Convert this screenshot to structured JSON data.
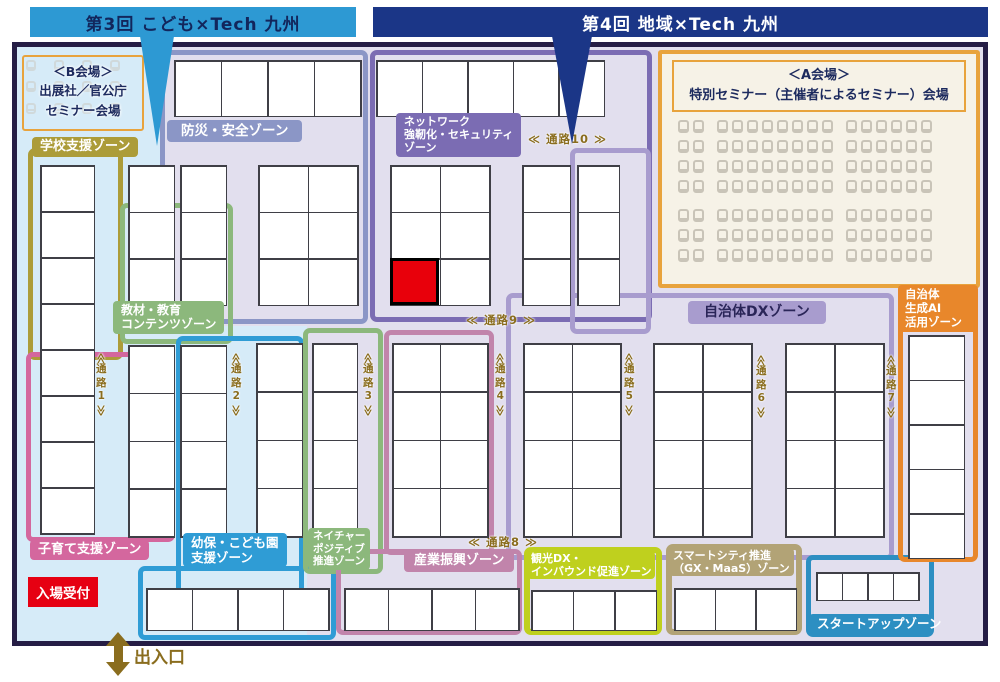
{
  "banners": {
    "left": {
      "label": "第3回 こども×Tech 九州",
      "color": "#2d99d3"
    },
    "right": {
      "label": "第4回 地域×Tech 九州",
      "color": "#1b3687"
    }
  },
  "halls": {
    "b": {
      "lines": [
        "＜B会場＞",
        "出展社／官公庁",
        "セミナー会場"
      ],
      "border_color": "#e8a33d",
      "seats": {
        "rows": 3,
        "cols": 4
      }
    },
    "a": {
      "lines": [
        "＜A会場＞",
        "特別セミナー（主催者によるセミナー）会場"
      ],
      "border_color": "#e8a33d",
      "seats": {
        "rows": 7,
        "groups": [
          2,
          8,
          6
        ]
      }
    }
  },
  "zones": {
    "school": {
      "label": "学校支援ゾーン",
      "color": "#ac9c39"
    },
    "bosai": {
      "label": "防災・安全ゾーン",
      "color": "#8b96c6"
    },
    "network": {
      "lines": [
        "ネットワーク",
        "強靭化・セキュリティ",
        "ゾーン"
      ],
      "color": "#7b6cb3"
    },
    "kyozai": {
      "lines": [
        "教材・教育",
        "コンテンツゾーン"
      ],
      "color": "#8cb87c"
    },
    "childcare": {
      "label": "子育て支援ゾーン",
      "color": "#d4679e"
    },
    "yoho": {
      "lines": [
        "幼保・こども園",
        "支援ゾーン"
      ],
      "color": "#2f9cd5"
    },
    "nature": {
      "lines": [
        "ネイチャー",
        "ポジティブ",
        "推進ゾーン"
      ],
      "color": "#8cb87c"
    },
    "sangyo": {
      "label": "産業振興ゾーン",
      "color": "#c184ab"
    },
    "kanko": {
      "lines": [
        "観光DX・",
        "インバウンド促進ゾーン"
      ],
      "color": "#bfd01e"
    },
    "smart": {
      "lines": [
        "スマートシティ推進",
        "（GX・MaaS）ゾーン"
      ],
      "color": "#b2a376"
    },
    "startup": {
      "label": "スタートアップゾーン",
      "color": "#2d8fc2"
    },
    "dx": {
      "label": "自治体DXゾーン",
      "color": "#a89cce"
    },
    "ai": {
      "lines": [
        "自治体",
        "生成AI",
        "活用ゾーン"
      ],
      "color": "#e8872b"
    }
  },
  "aisles": {
    "prefix": "≪",
    "suffix": "≫",
    "vertical": [
      "通路1",
      "通路2",
      "通路3",
      "通路4",
      "通路5",
      "通路6",
      "通路7"
    ],
    "horizontal": [
      "通路8",
      "通路9",
      "通路10"
    ]
  },
  "reception": {
    "label": "入場受付",
    "color": "#e60012"
  },
  "entrance": {
    "label": "出入口",
    "color": "#8a6d1e"
  },
  "highlight_booth": {
    "color": "#e8000b",
    "zone": "ネットワーク強靭化・セキュリティゾーン"
  },
  "map": {
    "grids": [
      {
        "id": "bosai-top-row",
        "x": 174,
        "y": 60,
        "cols": 4,
        "rows": 1,
        "cw": 45,
        "ch": 54
      },
      {
        "id": "network-top-row",
        "x": 376,
        "y": 60,
        "cols": 5,
        "rows": 1,
        "cw": 44,
        "ch": 54
      },
      {
        "id": "school-col",
        "x": 40,
        "y": 165,
        "cols": 1,
        "rows": 8,
        "cw": 52,
        "ch": 44.5
      },
      {
        "id": "col2-upper",
        "x": 128,
        "y": 165,
        "cols": 1,
        "rows": 3,
        "cw": 44,
        "ch": 45
      },
      {
        "id": "col2-lower",
        "x": 128,
        "y": 345,
        "cols": 1,
        "rows": 4,
        "cw": 44,
        "ch": 46.25
      },
      {
        "id": "col3-upper",
        "x": 180,
        "y": 165,
        "cols": 1,
        "rows": 3,
        "cw": 44,
        "ch": 45
      },
      {
        "id": "col3-lower",
        "x": 180,
        "y": 345,
        "cols": 1,
        "rows": 4,
        "cw": 44,
        "ch": 46.25
      },
      {
        "id": "bosai-grid",
        "x": 258,
        "y": 165,
        "cols": 2,
        "rows": 3,
        "cw": 48,
        "ch": 45
      },
      {
        "id": "network-grid",
        "x": 390,
        "y": 165,
        "cols": 2,
        "rows": 3,
        "cw": 48,
        "ch": 45
      },
      {
        "id": "network-col-right",
        "x": 522,
        "y": 165,
        "cols": 1,
        "rows": 3,
        "cw": 46,
        "ch": 45
      },
      {
        "id": "dx-arm-col",
        "x": 577,
        "y": 165,
        "cols": 1,
        "rows": 3,
        "cw": 40,
        "ch": 45
      },
      {
        "id": "col4-lower",
        "x": 256,
        "y": 343,
        "cols": 1,
        "rows": 4,
        "cw": 44,
        "ch": 46.75
      },
      {
        "id": "nature-col",
        "x": 312,
        "y": 343,
        "cols": 1,
        "rows": 4,
        "cw": 43,
        "ch": 46.75
      },
      {
        "id": "sangyo-upper-grid",
        "x": 392,
        "y": 343,
        "cols": 2,
        "rows": 4,
        "cw": 46,
        "ch": 46.75
      },
      {
        "id": "dx-grid-1",
        "x": 523,
        "y": 343,
        "cols": 2,
        "rows": 4,
        "cw": 47,
        "ch": 46.75
      },
      {
        "id": "dx-grid-2",
        "x": 653,
        "y": 343,
        "cols": 2,
        "rows": 4,
        "cw": 47.5,
        "ch": 46.75
      },
      {
        "id": "dx-grid-3",
        "x": 785,
        "y": 343,
        "cols": 2,
        "rows": 4,
        "cw": 47.5,
        "ch": 46.75
      },
      {
        "id": "ai-col",
        "x": 908,
        "y": 335,
        "cols": 1,
        "rows": 5,
        "cw": 54,
        "ch": 43
      },
      {
        "id": "yoho-bottom-row",
        "x": 146,
        "y": 588,
        "cols": 4,
        "rows": 1,
        "cw": 44,
        "ch": 40
      },
      {
        "id": "sangyo-bottom-row",
        "x": 344,
        "y": 588,
        "cols": 4,
        "rows": 1,
        "cw": 42,
        "ch": 40
      },
      {
        "id": "kanko-row",
        "x": 531,
        "y": 590,
        "cols": 3,
        "rows": 1,
        "cw": 40,
        "ch": 38
      },
      {
        "id": "smart-row",
        "x": 674,
        "y": 588,
        "cols": 3,
        "rows": 1,
        "cw": 39,
        "ch": 40
      },
      {
        "id": "startup-row",
        "x": 816,
        "y": 572,
        "cols": 4,
        "rows": 1,
        "cw": 24,
        "ch": 26
      }
    ]
  }
}
